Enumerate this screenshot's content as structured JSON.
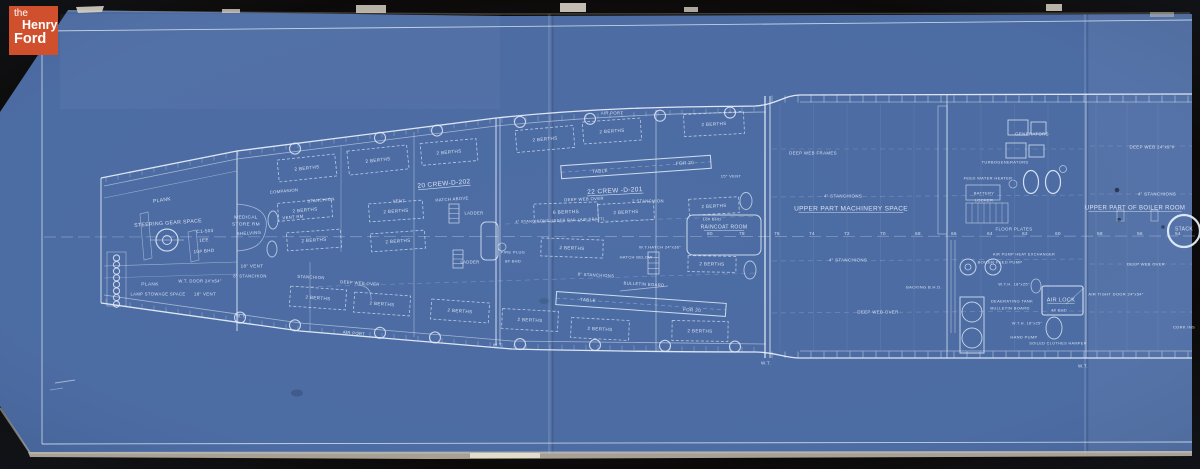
{
  "branding": {
    "logo_line1": "the",
    "logo_line2": "Henry",
    "logo_line3": "Ford",
    "logo_bg": "#d0502e"
  },
  "palette": {
    "photo_background": "#0c0a09",
    "blueprint_blue": "#4c6ca4",
    "line_white": "#e9f1fb",
    "paper_edge": "#cfc6b4"
  },
  "plan": {
    "frame_row_y": 235,
    "frame_numbers": [
      {
        "t": "80",
        "x": 710
      },
      {
        "t": "78",
        "x": 742
      },
      {
        "t": "76",
        "x": 777
      },
      {
        "t": "74",
        "x": 812
      },
      {
        "t": "72",
        "x": 847
      },
      {
        "t": "70",
        "x": 883
      },
      {
        "t": "68",
        "x": 918
      },
      {
        "t": "66",
        "x": 954
      },
      {
        "t": "64",
        "x": 990
      },
      {
        "t": "62",
        "x": 1025
      },
      {
        "t": "60",
        "x": 1058
      },
      {
        "t": "58",
        "x": 1100
      },
      {
        "t": "56",
        "x": 1140
      },
      {
        "t": "54",
        "x": 1178
      }
    ],
    "labels": [
      {
        "t": "PLANK",
        "x": 162,
        "y": 200,
        "s": 5,
        "r": -8
      },
      {
        "t": "STEERING GEAR SPACE",
        "x": 168,
        "y": 223,
        "s": 5.2,
        "r": -4
      },
      {
        "t": "C1-503",
        "x": 205,
        "y": 231,
        "s": 4.6,
        "r": -4
      },
      {
        "t": "1EE",
        "x": 204,
        "y": 240,
        "s": 4.6,
        "r": -4
      },
      {
        "t": "10# BHD",
        "x": 204,
        "y": 251,
        "s": 4.6,
        "r": -4
      },
      {
        "t": "MEDICAL",
        "x": 246,
        "y": 217,
        "s": 4.8
      },
      {
        "t": "STORE RM",
        "x": 246,
        "y": 224,
        "s": 4.8
      },
      {
        "t": "SHELVING",
        "x": 249,
        "y": 233,
        "s": 4.4,
        "r": -3
      },
      {
        "t": "18\" VENT",
        "x": 252,
        "y": 266,
        "s": 4.5
      },
      {
        "t": "8\" STANCHION",
        "x": 250,
        "y": 276,
        "s": 4.2
      },
      {
        "t": "PLANK",
        "x": 150,
        "y": 284,
        "s": 4.8
      },
      {
        "t": "W.T. DOOR 24\"x54\"",
        "x": 200,
        "y": 281,
        "s": 4.2
      },
      {
        "t": "LAMP STOWAGE SPACE",
        "x": 158,
        "y": 294,
        "s": 4.2
      },
      {
        "t": "18\" VENT",
        "x": 205,
        "y": 294,
        "s": 4.4
      },
      {
        "t": "W.T.",
        "x": 241,
        "y": 316,
        "s": 4.4
      },
      {
        "t": "COMPANION",
        "x": 284,
        "y": 191,
        "s": 4.2,
        "r": -5
      },
      {
        "t": "STANCHION",
        "x": 321,
        "y": 200,
        "s": 4.2,
        "r": -5
      },
      {
        "t": "VENT RM",
        "x": 293,
        "y": 217,
        "s": 4.2,
        "r": -5
      },
      {
        "t": "20 CREW-D-202",
        "x": 444,
        "y": 184,
        "s": 6.5,
        "r": -5,
        "u": 1
      },
      {
        "t": "22 CREW -D-201",
        "x": 615,
        "y": 191,
        "s": 6.5,
        "r": -3,
        "u": 1
      },
      {
        "t": "VENT",
        "x": 399,
        "y": 201,
        "s": 4.2
      },
      {
        "t": "HATCH ABOVE",
        "x": 452,
        "y": 199,
        "s": 4.2,
        "r": -4
      },
      {
        "t": "LADDER",
        "x": 474,
        "y": 213,
        "s": 4.2
      },
      {
        "t": "LADDER",
        "x": 470,
        "y": 262,
        "s": 4.2
      },
      {
        "t": "DEEP WEB OVER",
        "x": 584,
        "y": 199,
        "s": 4.2,
        "r": -2
      },
      {
        "t": "2 STANCHION",
        "x": 648,
        "y": 201,
        "s": 4.2
      },
      {
        "t": "6 BERTHS",
        "x": 566,
        "y": 212,
        "s": 4.8,
        "r": -2,
        "b": [
          64,
          18
        ]
      },
      {
        "t": "4\" STANCHIONS UNDER RAIL (AIR DRAFT)",
        "x": 560,
        "y": 220,
        "s": 3.8,
        "r": -2
      },
      {
        "t": "W.T.HATCH 24\"x36\"",
        "x": 660,
        "y": 247,
        "s": 4
      },
      {
        "t": "HATCH BELOW",
        "x": 636,
        "y": 257,
        "s": 4
      },
      {
        "t": "FIRE PLUG",
        "x": 513,
        "y": 252,
        "s": 4
      },
      {
        "t": "8# BHD",
        "x": 513,
        "y": 261,
        "s": 4
      },
      {
        "t": "STANCHION",
        "x": 311,
        "y": 277,
        "s": 4.2,
        "r": 3
      },
      {
        "t": "DEEP WEB OVER",
        "x": 360,
        "y": 283,
        "s": 4.2,
        "r": 4
      },
      {
        "t": "8\" STANCHIONS",
        "x": 596,
        "y": 275,
        "s": 4.2,
        "r": 3
      },
      {
        "t": "BULLETIN BOARD",
        "x": 644,
        "y": 284,
        "s": 4.2,
        "r": 3
      },
      {
        "t": "AIR PORT",
        "x": 612,
        "y": 113,
        "s": 4.2
      },
      {
        "t": "AIR PORT",
        "x": 354,
        "y": 333,
        "s": 4.2,
        "r": 5
      },
      {
        "t": "W.T.",
        "x": 498,
        "y": 345,
        "s": 4.4
      },
      {
        "t": "15\" VENT",
        "x": 731,
        "y": 176,
        "s": 4
      },
      {
        "t": "10# BHD",
        "x": 712,
        "y": 219,
        "s": 4
      },
      {
        "t": "RAINCOAT ROOM",
        "x": 724,
        "y": 227,
        "s": 5,
        "u": 1
      },
      {
        "t": "TABLE",
        "x": 600,
        "y": 171,
        "s": 4.6,
        "r": -4
      },
      {
        "t": "FOR 20",
        "x": 685,
        "y": 163,
        "s": 4.6,
        "r": -4
      },
      {
        "t": "TABLE",
        "x": 588,
        "y": 300,
        "s": 4.6,
        "r": 4
      },
      {
        "t": "FOR 20",
        "x": 692,
        "y": 310,
        "s": 4.6,
        "r": 4
      },
      {
        "t": "2 BERTHS",
        "x": 307,
        "y": 168,
        "s": 4.6,
        "r": -6,
        "b": [
          58,
          22
        ]
      },
      {
        "t": "2 BERTHS",
        "x": 378,
        "y": 160,
        "s": 4.6,
        "r": -6,
        "b": [
          60,
          24
        ]
      },
      {
        "t": "2 BERTHS",
        "x": 449,
        "y": 152,
        "s": 4.6,
        "r": -5,
        "b": [
          56,
          22
        ]
      },
      {
        "t": "2 BERTHS",
        "x": 545,
        "y": 139,
        "s": 4.6,
        "r": -5,
        "b": [
          58,
          22
        ]
      },
      {
        "t": "2 BERTHS",
        "x": 612,
        "y": 131,
        "s": 4.6,
        "r": -4,
        "b": [
          58,
          22
        ]
      },
      {
        "t": "2 BERTHS",
        "x": 714,
        "y": 124,
        "s": 4.6,
        "r": -3,
        "b": [
          60,
          22
        ]
      },
      {
        "t": "2 BERTHS",
        "x": 305,
        "y": 210,
        "s": 4.6,
        "r": -5,
        "b": [
          54,
          18
        ]
      },
      {
        "t": "2 BERTHS",
        "x": 396,
        "y": 211,
        "s": 4.6,
        "r": -4,
        "b": [
          54,
          18
        ]
      },
      {
        "t": "2 BERTHS",
        "x": 626,
        "y": 212,
        "s": 4.6,
        "r": -3,
        "b": [
          56,
          18
        ]
      },
      {
        "t": "2 BERTHS",
        "x": 714,
        "y": 206,
        "s": 4.6,
        "r": -3,
        "b": [
          50,
          16
        ]
      },
      {
        "t": "2 BERTHS",
        "x": 314,
        "y": 240,
        "s": 4.6,
        "r": -4,
        "b": [
          54,
          18
        ]
      },
      {
        "t": "2 BERTHS",
        "x": 398,
        "y": 241,
        "s": 4.6,
        "r": -4,
        "b": [
          54,
          18
        ]
      },
      {
        "t": "2 BERTHS",
        "x": 572,
        "y": 248,
        "s": 4.6,
        "r": 2,
        "b": [
          62,
          18
        ]
      },
      {
        "t": "2 BERTHS",
        "x": 712,
        "y": 264,
        "s": 4.6,
        "r": 1,
        "b": [
          48,
          16
        ]
      },
      {
        "t": "2 BERTHS",
        "x": 318,
        "y": 298,
        "s": 4.6,
        "r": 4,
        "b": [
          56,
          20
        ]
      },
      {
        "t": "2 BERTHS",
        "x": 382,
        "y": 304,
        "s": 4.6,
        "r": 4,
        "b": [
          56,
          20
        ]
      },
      {
        "t": "2 BERTHS",
        "x": 460,
        "y": 311,
        "s": 4.6,
        "r": 4,
        "b": [
          58,
          20
        ]
      },
      {
        "t": "2 BERTHS",
        "x": 530,
        "y": 320,
        "s": 4.6,
        "r": 3,
        "b": [
          56,
          20
        ]
      },
      {
        "t": "2 BERTHS",
        "x": 600,
        "y": 329,
        "s": 4.6,
        "r": 3,
        "b": [
          58,
          20
        ]
      },
      {
        "t": "2 BERTHS",
        "x": 700,
        "y": 331,
        "s": 4.6,
        "r": 1,
        "b": [
          56,
          20
        ]
      },
      {
        "t": "DEEP WEB FRAMES",
        "x": 813,
        "y": 153,
        "s": 4.4
      },
      {
        "t": "4\" STANCHIONS",
        "x": 843,
        "y": 196,
        "s": 4.4
      },
      {
        "t": "UPPER PART MACHINERY SPACE",
        "x": 851,
        "y": 209,
        "s": 6.5,
        "u": 1
      },
      {
        "t": "4\" STANCHIONS",
        "x": 848,
        "y": 260,
        "s": 4.4
      },
      {
        "t": "BACKING B.H.D.",
        "x": 924,
        "y": 287,
        "s": 4
      },
      {
        "t": "DEEP WEB OVER",
        "x": 878,
        "y": 312,
        "s": 4.4
      },
      {
        "t": "GENERATORS",
        "x": 1032,
        "y": 134,
        "s": 4.4
      },
      {
        "t": "TURBOGENERATORS",
        "x": 1005,
        "y": 162,
        "s": 4
      },
      {
        "t": "FEED WATER HEATER",
        "x": 988,
        "y": 178,
        "s": 4
      },
      {
        "t": "BATTERY",
        "x": 984,
        "y": 193,
        "s": 4
      },
      {
        "t": "LOCKER",
        "x": 984,
        "y": 200,
        "s": 4
      },
      {
        "t": "FLOOR PLATES",
        "x": 1014,
        "y": 229,
        "s": 4.4
      },
      {
        "t": "AIR PUMP HEAT EXCHANGER",
        "x": 1024,
        "y": 254,
        "s": 3.8
      },
      {
        "t": "BOILER FEED PUMP",
        "x": 1000,
        "y": 262,
        "s": 4
      },
      {
        "t": "W.T.H. 18\"x25\"",
        "x": 1014,
        "y": 284,
        "s": 4
      },
      {
        "t": "DEAERATING TANK",
        "x": 1012,
        "y": 301,
        "s": 4
      },
      {
        "t": "BULLETIN BOARD",
        "x": 1010,
        "y": 308,
        "s": 4
      },
      {
        "t": "W.T.H. 18\"x25\"",
        "x": 1027,
        "y": 323,
        "s": 3.8
      },
      {
        "t": "HAND PUMP",
        "x": 1024,
        "y": 337,
        "s": 4
      },
      {
        "t": "SOILED CLOTHES HAMPER",
        "x": 1058,
        "y": 343,
        "s": 3.8
      },
      {
        "t": "AIR LOCK",
        "x": 1061,
        "y": 300,
        "s": 5.5,
        "u": 1
      },
      {
        "t": "4# BHD",
        "x": 1059,
        "y": 310,
        "s": 4
      },
      {
        "t": "AIR TIGHT DOOR 24\"x54\"",
        "x": 1116,
        "y": 294,
        "s": 4
      },
      {
        "t": "W.T.",
        "x": 766,
        "y": 363,
        "s": 4.4
      },
      {
        "t": "W.T.",
        "x": 1083,
        "y": 366,
        "s": 4.4
      },
      {
        "t": "DEEP WEB 24\"x9\"#",
        "x": 1152,
        "y": 147,
        "s": 4.4
      },
      {
        "t": "4\" STANCHIONS",
        "x": 1157,
        "y": 194,
        "s": 4.4
      },
      {
        "t": "UPPER PART OF BOILER ROOM",
        "x": 1135,
        "y": 208,
        "s": 6,
        "u": 1
      },
      {
        "t": "STACK",
        "x": 1184,
        "y": 229,
        "s": 5
      },
      {
        "t": "DEEP WEB OVER",
        "x": 1146,
        "y": 264,
        "s": 4
      },
      {
        "t": "CORK INS",
        "x": 1184,
        "y": 327,
        "s": 4
      }
    ]
  }
}
